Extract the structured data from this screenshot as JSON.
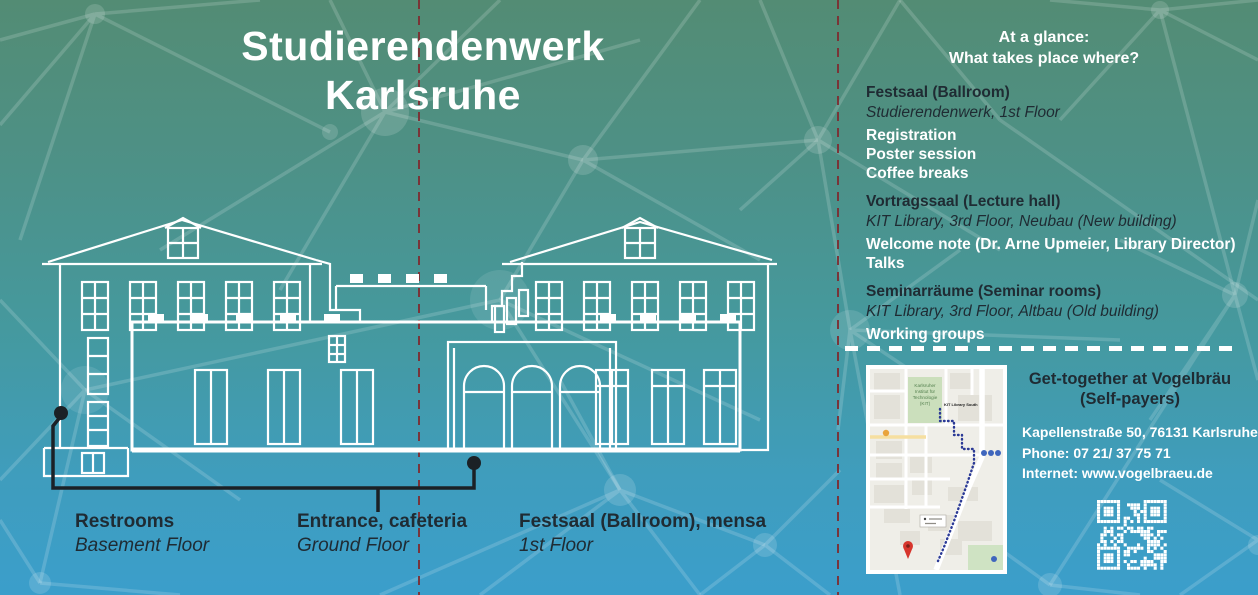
{
  "left_panel": {
    "title": {
      "line1": "Studierendenwerk",
      "line2": "Karlsruhe"
    },
    "floor_labels": [
      {
        "name": "Restrooms",
        "floor": "Basement Floor"
      },
      {
        "name": "Entrance, cafeteria",
        "floor": "Ground Floor"
      },
      {
        "name": "Festsaal (Ballroom), mensa",
        "floor": "1st Floor"
      }
    ]
  },
  "right_panel": {
    "heading": {
      "line1": "At a glance:",
      "line2": "What takes place where?"
    },
    "sections": [
      {
        "title": "Festsaal (Ballroom)",
        "location": "Studierendenwerk, 1st Floor",
        "items": [
          "Registration",
          "Poster session",
          "Coffee breaks"
        ]
      },
      {
        "title": "Vortragssaal (Lecture hall)",
        "location": "KIT Library, 3rd Floor, Neubau (New building)",
        "items": [
          "Welcome note (Dr. Arne Upmeier, Library Director)",
          "Talks"
        ]
      },
      {
        "title": "Seminarräume (Seminar rooms)",
        "location": "KIT Library, 3rd Floor, Altbau (Old building)",
        "items": [
          "Working groups"
        ]
      }
    ],
    "get_together": {
      "title_line1": "Get-together at Vogelbräu",
      "title_line2": "(Self-payers)",
      "address": "Kapellenstraße 50, 76131 Karlsruhe",
      "phone": "Phone: 07 21/ 37 75 71",
      "internet": "Internet: www.vogelbraeu.de"
    },
    "map": {
      "kit_line1": "Karlsruher",
      "kit_line2": "Institut für",
      "kit_line3": "Technologie",
      "kit_line4": "(KIT)",
      "library_label": "KIT Library South"
    }
  },
  "colors": {
    "gradient_top": "#538c74",
    "gradient_bottom": "#3b9ecb",
    "fold_line": "#8a383c",
    "dark_text": "#1f2b33",
    "route": "#2b3a96",
    "pin": "#d7352c"
  }
}
